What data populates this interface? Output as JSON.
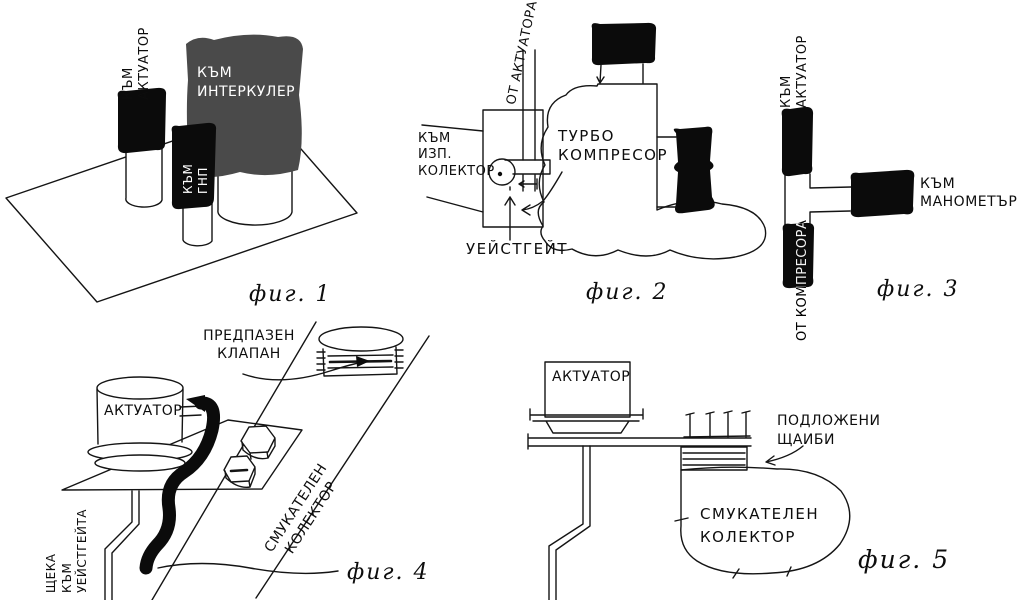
{
  "colors": {
    "background": "#ffffff",
    "ink": "#141414",
    "hose_black": "#0b0b0b",
    "intercooler_gray": "#4a4a4a"
  },
  "figures": {
    "fig1": {
      "caption": "фиг. 1",
      "labels": {
        "to_actuator": "КЪМ\nАКТУАТОР",
        "to_intercooler": "КЪМ\nИНТЕРКУЛЕР",
        "to_gnp": "КЪМ\nГНП"
      }
    },
    "fig2": {
      "caption": "фиг. 2",
      "labels": {
        "from_actuator": "ОТ АКТУАТОРА",
        "to_exhaust_manifold": "КЪМ\nИЗП.\nКОЛЕКТОР",
        "turbo_compressor": "ТУРБО\nКОМПРЕСОР",
        "wastegate": "УЕЙСТГЕЙТ"
      }
    },
    "fig3": {
      "caption": "фиг. 3",
      "labels": {
        "to_actuator": "КЪМ\nАКТУАТОР",
        "to_manometer": "КЪМ\nМАНОМЕТЪР",
        "from_compressor": "ОТ КОМПРЕСОРА"
      }
    },
    "fig4": {
      "caption": "фиг. 4",
      "labels": {
        "safety_valve": "ПРЕДПАЗЕН\nКЛАПАН",
        "actuator": "АКТУАТОР",
        "rod_to_wastegate": "ЩЕКА\nКЪМ\nУЕЙСТГЕЙТА",
        "intake_manifold": "СМУКАТЕЛЕН\nКОЛЕКТОР"
      }
    },
    "fig5": {
      "caption": "фиг. 5",
      "labels": {
        "actuator": "АКТУАТОР",
        "shim_washers": "ПОДЛОЖЕНИ\nЩАИБИ",
        "intake_manifold": "СМУКАТЕЛЕН\nКОЛЕКТОР"
      }
    }
  }
}
